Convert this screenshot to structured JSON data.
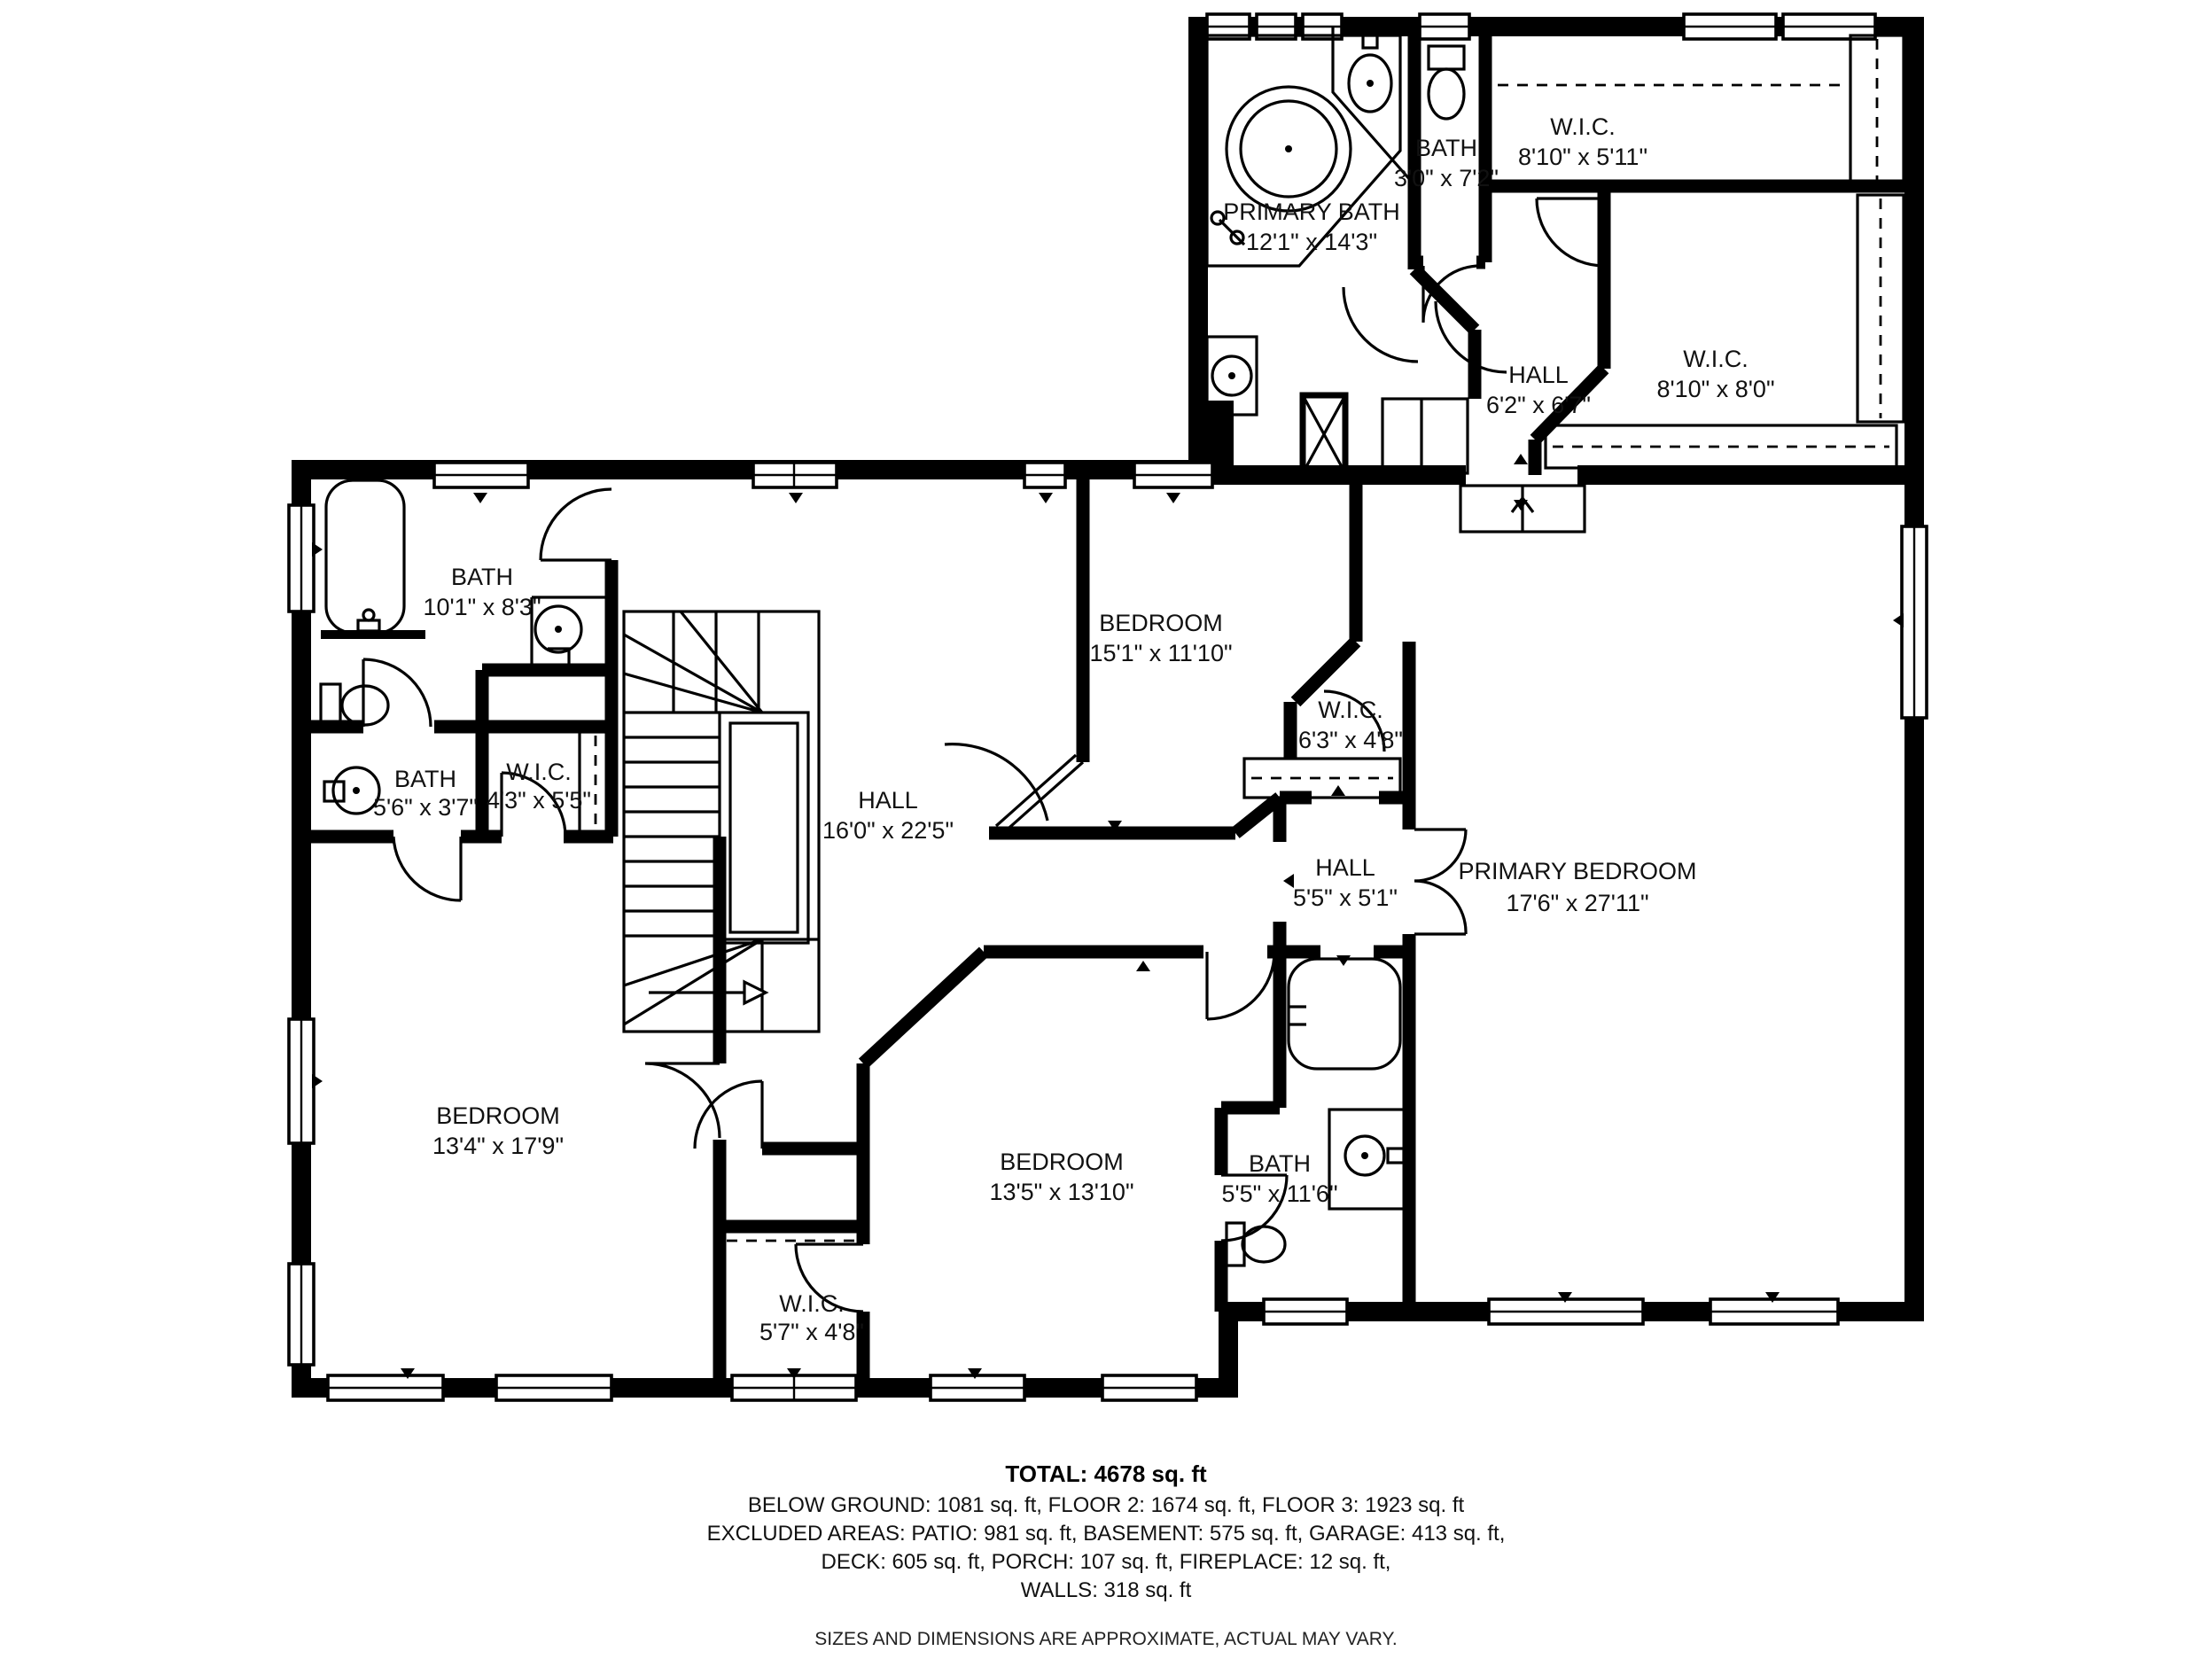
{
  "plan": {
    "floor_note": "upper floor plan",
    "colors": {
      "wall": "#000000",
      "background": "#ffffff",
      "text": "#111111"
    }
  },
  "rooms": [
    {
      "id": "primary-bath",
      "name": "PRIMARY BATH",
      "dims": "12'1\" x 14'3\""
    },
    {
      "id": "bath-small-top",
      "name": "BATH",
      "dims": "3'0\" x 7'2\""
    },
    {
      "id": "wic-top-right",
      "name": "W.I.C.",
      "dims": "8'10\" x 5'11\""
    },
    {
      "id": "wic-mid-right",
      "name": "W.I.C.",
      "dims": "8'10\" x 8'0\""
    },
    {
      "id": "hall-upper",
      "name": "HALL",
      "dims": "6'2\" x 6'7\""
    },
    {
      "id": "bath-top-left",
      "name": "BATH",
      "dims": "10'1\" x 8'3\""
    },
    {
      "id": "bedroom-center",
      "name": "BEDROOM",
      "dims": "15'1\" x 11'10\""
    },
    {
      "id": "wic-center",
      "name": "W.I.C.",
      "dims": "6'3\" x 4'8\""
    },
    {
      "id": "bath-mid-left",
      "name": "BATH",
      "dims": "5'6\" x 3'7\""
    },
    {
      "id": "wic-mid-left",
      "name": "W.I.C.",
      "dims": "4'3\" x 5'5\""
    },
    {
      "id": "hall-main",
      "name": "HALL",
      "dims": "16'0\" x 22'5\""
    },
    {
      "id": "hall-small",
      "name": "HALL",
      "dims": "5'5\" x 5'1\""
    },
    {
      "id": "primary-bedroom",
      "name": "PRIMARY BEDROOM",
      "dims": "17'6\" x 27'11\""
    },
    {
      "id": "bedroom-left",
      "name": "BEDROOM",
      "dims": "13'4\" x 17'9\""
    },
    {
      "id": "bedroom-bottom",
      "name": "BEDROOM",
      "dims": "13'5\" x 13'10\""
    },
    {
      "id": "bath-bottom",
      "name": "BATH",
      "dims": "5'5\" x 11'6\""
    },
    {
      "id": "wic-bottom",
      "name": "W.I.C.",
      "dims": "5'7\" x 4'8\""
    }
  ],
  "summary": {
    "total": "TOTAL: 4678 sq. ft",
    "line1": "BELOW GROUND: 1081 sq. ft, FLOOR 2: 1674 sq. ft, FLOOR 3: 1923 sq. ft",
    "line2": "EXCLUDED AREAS: PATIO: 981 sq. ft, BASEMENT: 575 sq. ft, GARAGE: 413 sq. ft,",
    "line3": "DECK: 605 sq. ft, PORCH: 107 sq. ft, FIREPLACE: 12 sq. ft,",
    "line4": "WALLS: 318 sq. ft",
    "disclaimer": "SIZES AND DIMENSIONS ARE APPROXIMATE, ACTUAL MAY VARY."
  }
}
